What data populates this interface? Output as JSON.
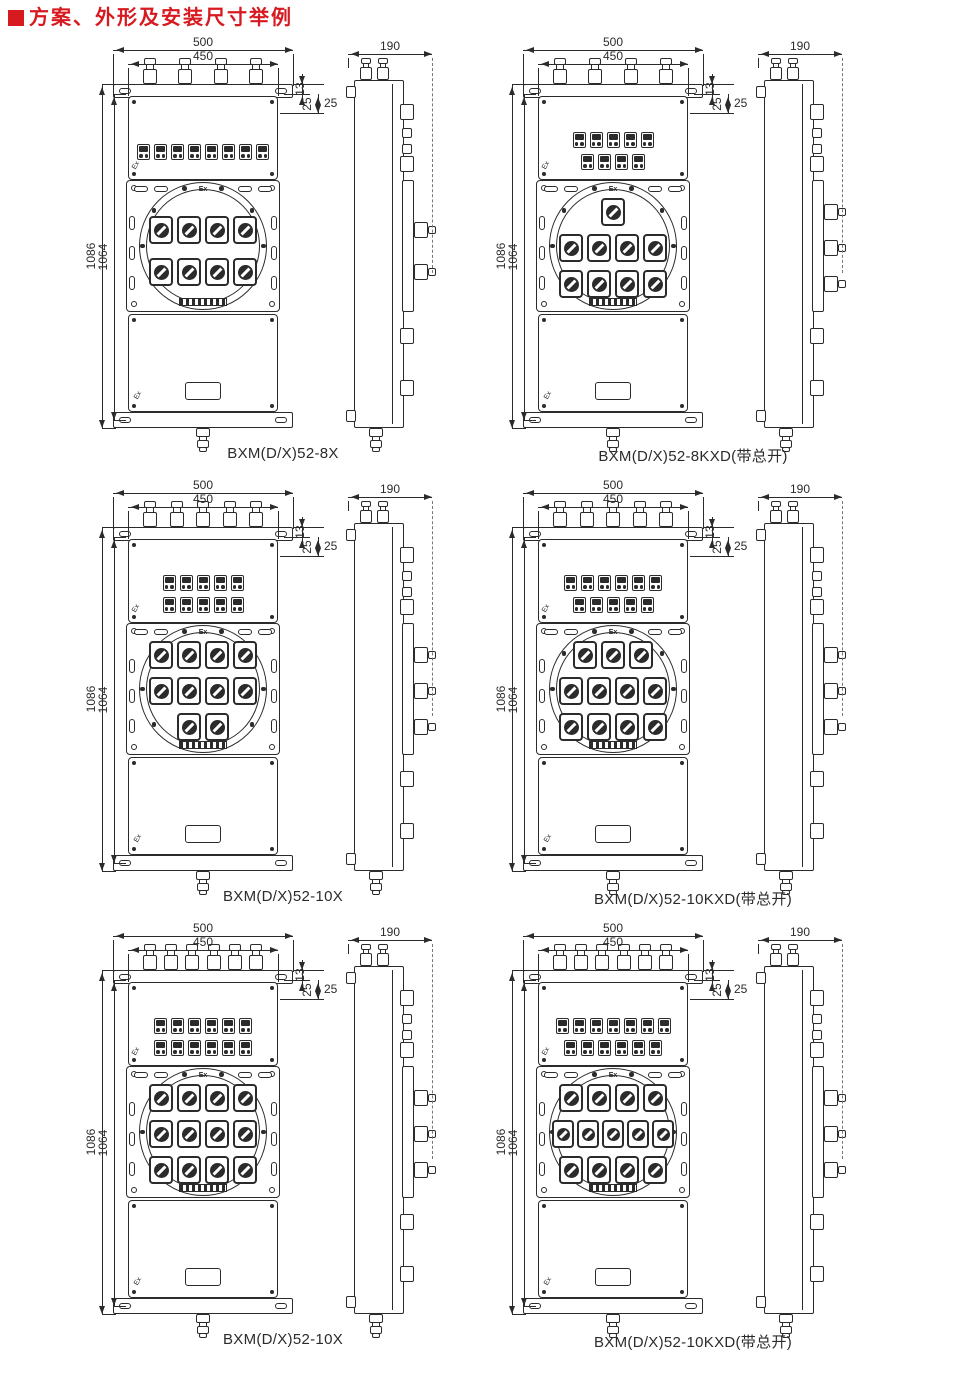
{
  "page": {
    "title": "方案、外形及安装尺寸举例"
  },
  "colors": {
    "accent": "#d71920",
    "line": "#2b2b2b",
    "fill": "#ffffff"
  },
  "shared_dims": {
    "width_outer": "500",
    "width_inner": "450",
    "flange_offset": "13",
    "edge_offset": "25",
    "height_outer": "1086",
    "height_inner": "1064",
    "depth": "190"
  },
  "marks": {
    "ex": "Ex"
  },
  "drawings": [
    {
      "caption": "BXM(D/X)52-8X",
      "glands": 4,
      "indicator_rows": [
        8
      ],
      "switch_rows": [
        4,
        4
      ],
      "main_switch": false
    },
    {
      "caption": "BXM(D/X)52-8KXD(带总开)",
      "glands": 4,
      "indicator_rows": [
        5,
        4
      ],
      "switch_rows": [
        1,
        4,
        4
      ],
      "main_switch": true
    },
    {
      "caption": "BXM(D/X)52-10X",
      "glands": 5,
      "indicator_rows": [
        5,
        5
      ],
      "switch_rows": [
        4,
        4,
        2
      ],
      "main_switch": false
    },
    {
      "caption": "BXM(D/X)52-10KXD(带总开)",
      "glands": 5,
      "indicator_rows": [
        6,
        5
      ],
      "switch_rows": [
        3,
        4,
        4
      ],
      "main_switch": true
    },
    {
      "caption": "BXM(D/X)52-10X",
      "glands": 6,
      "indicator_rows": [
        6,
        6
      ],
      "switch_rows": [
        4,
        4,
        4
      ],
      "main_switch": false
    },
    {
      "caption": "BXM(D/X)52-10KXD(带总开)",
      "glands": 6,
      "indicator_rows": [
        7,
        6
      ],
      "switch_rows": [
        4,
        5,
        4
      ],
      "main_switch": true
    }
  ]
}
